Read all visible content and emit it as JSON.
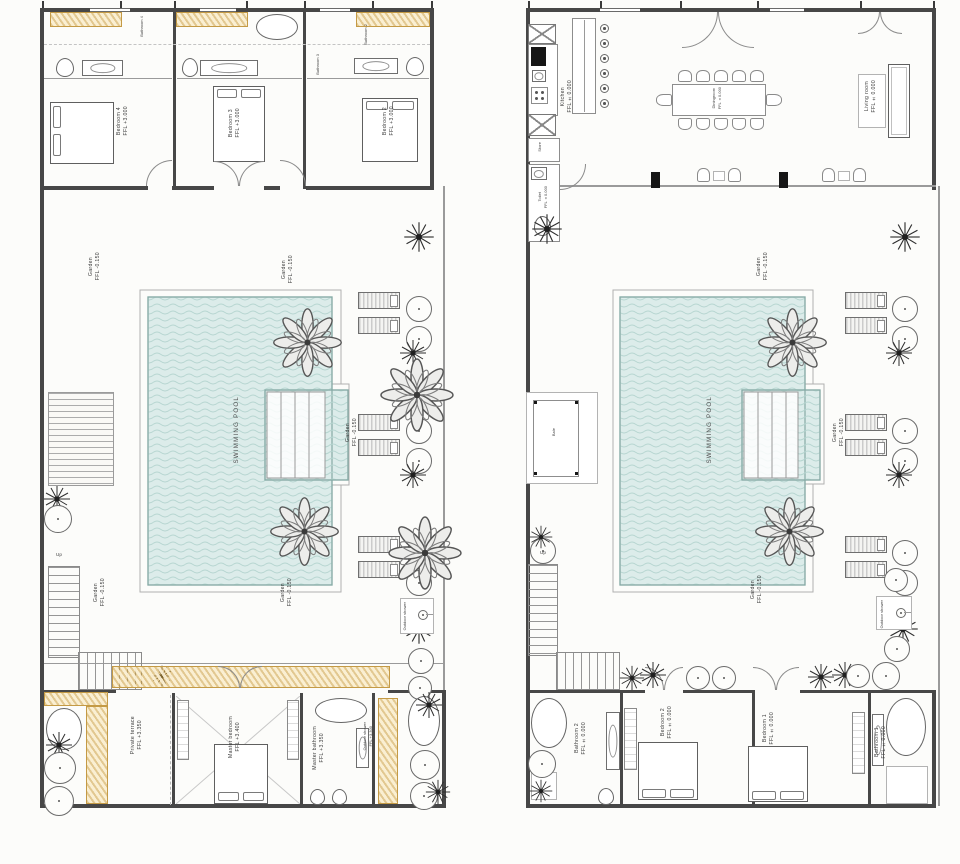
{
  "shared": {
    "swimming_pool": "SWIMMING POOL",
    "garden": {
      "name": "Garden",
      "ffl": "FFL -0.150"
    },
    "up": "Up",
    "outdoor_shower": "Outdoor shower",
    "bale": "Bale"
  },
  "left_plan": {
    "bedroom_4": {
      "name": "Bedroom 4",
      "ffl": "FFL +3.000"
    },
    "bedroom_3": {
      "name": "Bedroom 3",
      "ffl": "FFL +3.000"
    },
    "bedroom_2": {
      "name": "Bedroom 2",
      "ffl": "FFL +3.000"
    },
    "bathroom_4": "Bathroom 4",
    "bathroom_3": "Bathroom 3",
    "bathroom_2": "Bathroom 2",
    "private_terrace": {
      "name": "Private terrace",
      "ffl": "FFL +3.350"
    },
    "master_bedroom": {
      "name": "Master bedroom",
      "ffl": "FFL +3.400"
    },
    "master_bathroom": {
      "name": "Master bathroom",
      "ffl": "FFL +3.350"
    },
    "outdoor_shower": {
      "name": "Outdoor shower",
      "ffl": "FFL +3.300"
    }
  },
  "right_plan": {
    "kitchen": {
      "name": "Kitchen",
      "ffl": "FFL ±0.000"
    },
    "diningroom": {
      "name": "Diningroom",
      "ffl": "FFL ±0.000"
    },
    "living_room": {
      "name": "Living room",
      "ffl": "FFL ±0.000"
    },
    "store": "Store",
    "toilet": {
      "name": "Toilet",
      "ffl": "FFL ±0.000"
    },
    "bathroom_2": {
      "name": "Bathroom 2",
      "ffl": "FFL ±0.000"
    },
    "bedroom_2": {
      "name": "Bedroom 2",
      "ffl": "FFL ±0.000"
    },
    "bedroom_1": {
      "name": "Bedroom 1",
      "ffl": "FFL ±0.000"
    },
    "bathroom_1": {
      "name": "Bathroom 1",
      "ffl": "FFL ±0.000"
    }
  },
  "colors": {
    "pool_fill": "#dcecea",
    "pool_wave": "#b7d6d1",
    "wall": "#474747",
    "planter": "#cd9d3a"
  }
}
